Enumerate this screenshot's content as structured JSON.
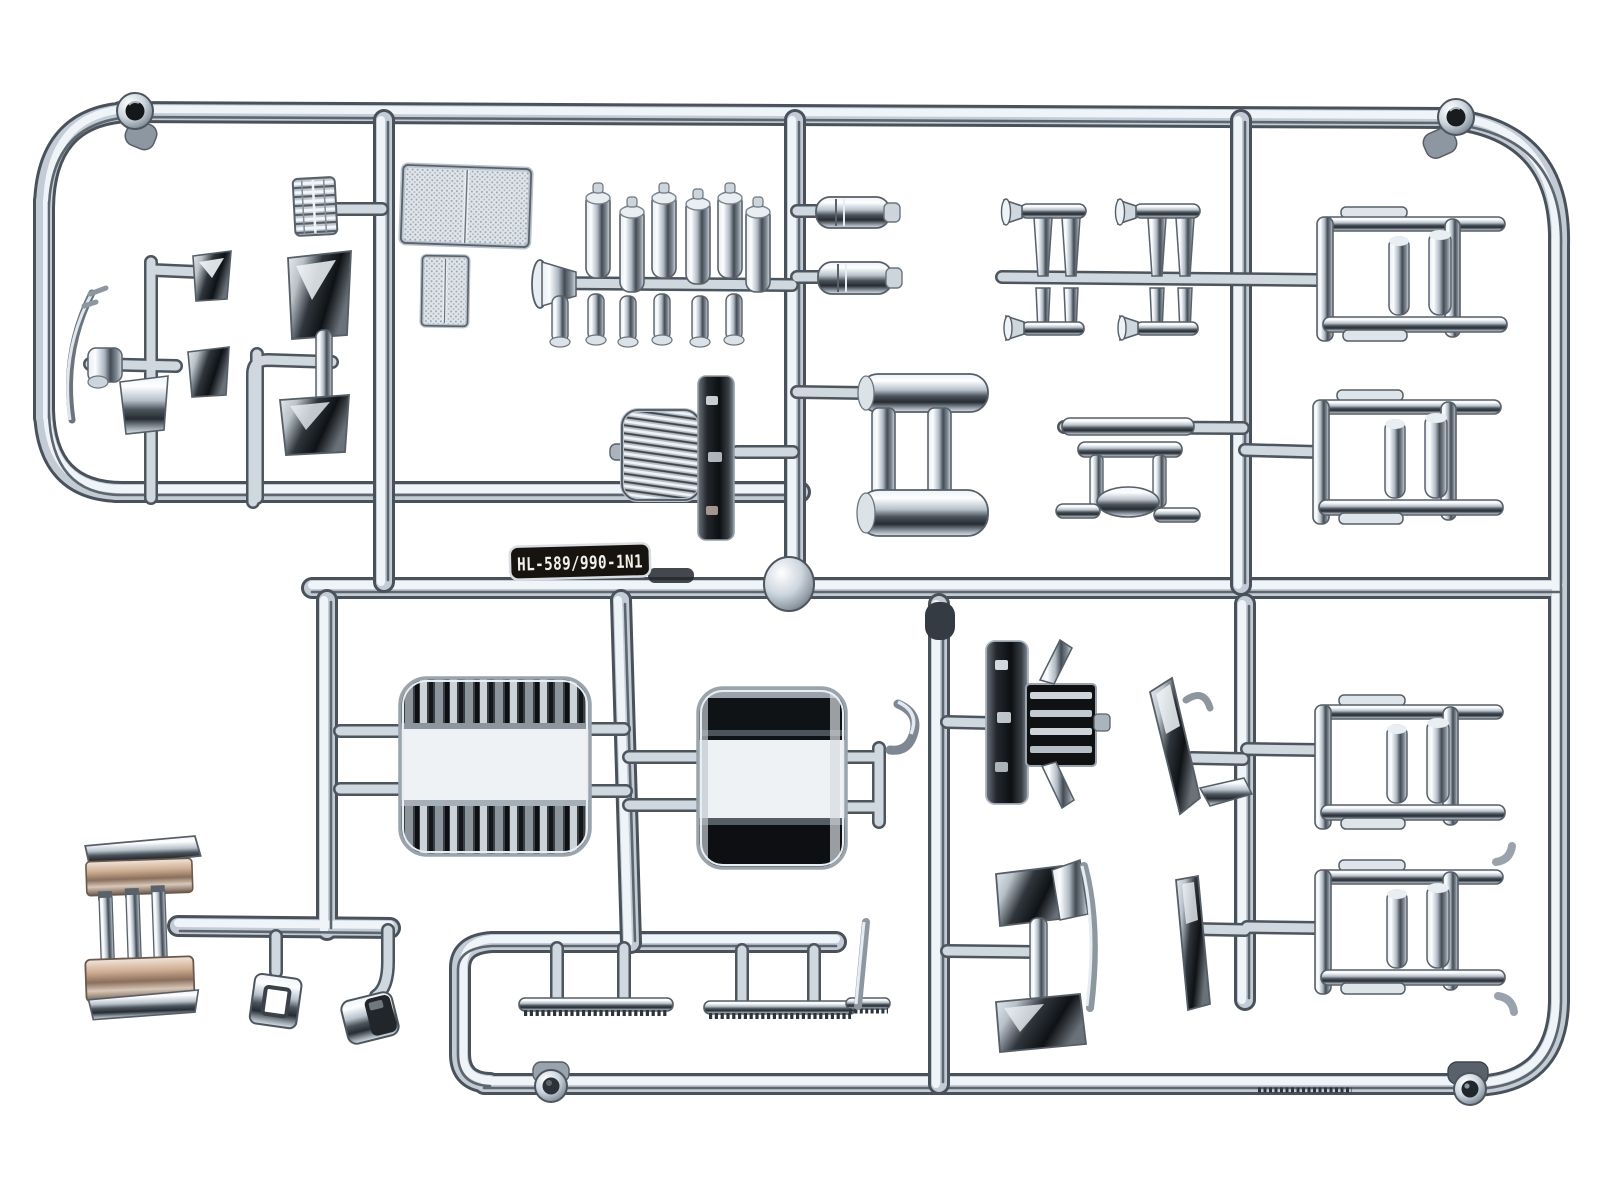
{
  "image": {
    "kind": "photograph",
    "subject": "chrome-plated plastic model-kit parts sprue (runner tree) on a white background",
    "orientation": "two joined rounded-rectangle runner frames, parts attached by short gates"
  },
  "label": {
    "text": "HL-589/990-1N1",
    "plate_color": "#17130f",
    "text_color": "#f3f0ea"
  },
  "palette": {
    "background": "#ffffff",
    "chrome_light": "#f2f7fb",
    "chrome_mid": "#b9c3cd",
    "chrome_dark": "#3f464e",
    "reflection_black": "#101316",
    "bumper_warm_tint": "#c9a98f"
  },
  "parts": [
    {
      "id": "mounting-hole-boss",
      "count": 4,
      "note": "round bosses with dark through-holes at sprue corners"
    },
    {
      "id": "mesh-grille-large",
      "note": "two-pane textured mesh panel, top centre-left"
    },
    {
      "id": "mesh-grille-small",
      "note": "two-pane mesh panel below the large one"
    },
    {
      "id": "ribbed-step-plate",
      "note": "small ribbed box part near top left"
    },
    {
      "id": "mirror-and-wiper-cluster",
      "note": "mirror heads, arms, posts and wiper blade, left side"
    },
    {
      "id": "engine-stack-cluster",
      "note": "row of bottle-shaped stacks on a bar with funnel end, top centre"
    },
    {
      "id": "muffler-cylinders",
      "count": 2,
      "note": "stepped cylinders right of centre vertical runner"
    },
    {
      "id": "air-cleaner-with-panel",
      "note": "ribbed round-corner face plus dark side panel, centre"
    },
    {
      "id": "roll-bar-h-frame",
      "note": "two cylinders joined by flat bars"
    },
    {
      "id": "air-horn-pairs",
      "count": 2,
      "note": "twin trumpet horns crossing a runner, top right"
    },
    {
      "id": "bracket-stool-part",
      "note": "small table-like bracket below horns"
    },
    {
      "id": "step-frame-brackets",
      "count": 4,
      "note": "square frames with long side bars, right column top and bottom"
    },
    {
      "id": "fuel-tank-large",
      "count": 2,
      "note": "dark reflective rounded tanks, bottom centre"
    },
    {
      "id": "front-bumper-shell",
      "note": "warm-tinted chrome bumper with vertical bars, bottom left"
    },
    {
      "id": "square-ring-part",
      "note": "small square annulus hanging from runner"
    },
    {
      "id": "canister-part",
      "note": "small tilted drum hanging from elbow"
    },
    {
      "id": "tread-strips",
      "count": 2,
      "note": "serrated step strips on lower runner"
    },
    {
      "id": "front-grille-assembly",
      "note": "dark panel with horizontal chrome slats and wing blades"
    },
    {
      "id": "sun-visor-blades",
      "count": 2,
      "note": "thin angled blades, lower right"
    },
    {
      "id": "door-mirror-set",
      "note": "two dark mirror heads joined by a bar, bottom centre-right"
    },
    {
      "id": "exhaust-hook",
      "note": "small J-hook between tank and runner"
    }
  ]
}
